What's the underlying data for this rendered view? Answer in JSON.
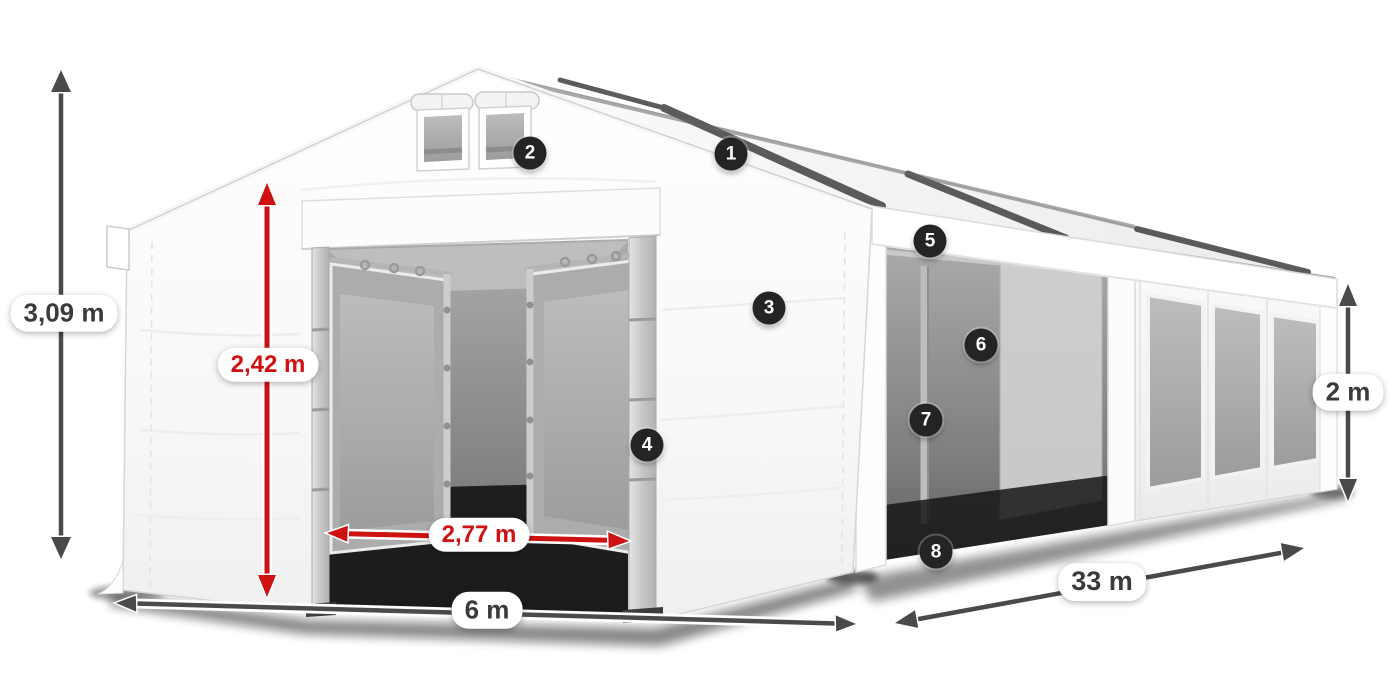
{
  "diagram": {
    "type": "product-dimension-diagram",
    "subject": "white marquee storage tent with dimension arrows and numbered part hotspots"
  },
  "measurements": {
    "total_height": {
      "label": "3,09 m",
      "style": "dark"
    },
    "inner_height": {
      "label": "2,42 m",
      "style": "red"
    },
    "door_width": {
      "label": "2,77 m",
      "style": "red"
    },
    "span_width": {
      "label": "6 m",
      "style": "dark"
    },
    "length": {
      "label": "33 m",
      "style": "dark"
    },
    "side_height": {
      "label": "2 m",
      "style": "dark"
    }
  },
  "callouts": [
    {
      "number": "1"
    },
    {
      "number": "2"
    },
    {
      "number": "3"
    },
    {
      "number": "4"
    },
    {
      "number": "5"
    },
    {
      "number": "6"
    },
    {
      "number": "7"
    },
    {
      "number": "8"
    }
  ],
  "colors": {
    "dimension_red": "#ce1111",
    "dimension_gray": "#4a4a4a",
    "callout_bg": "#242424",
    "label_text_dark": "#3a3a3a",
    "pill_bg": "#ffffff"
  }
}
